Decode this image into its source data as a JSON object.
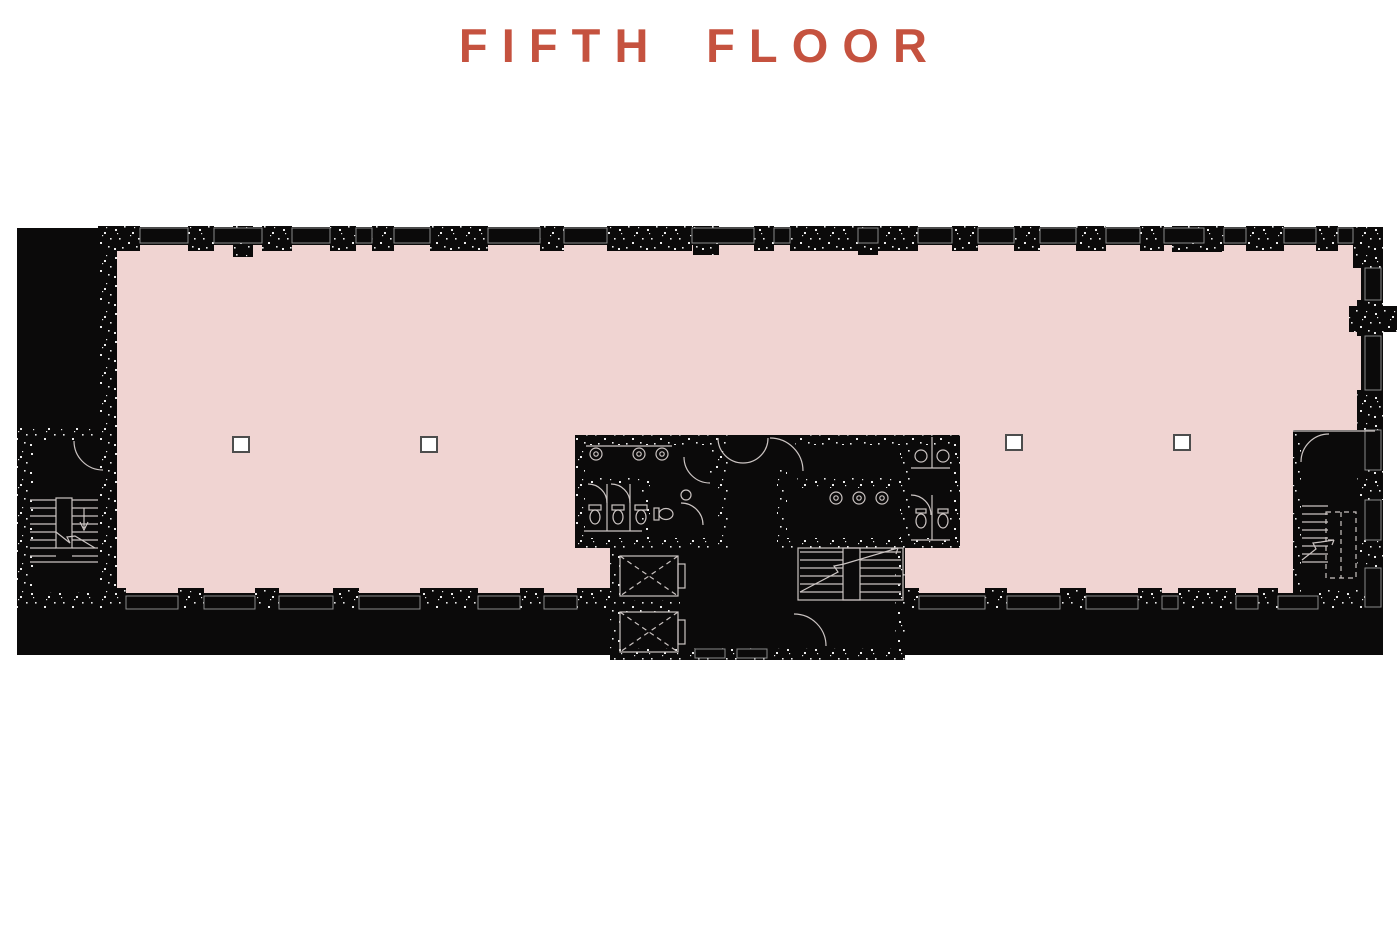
{
  "title": {
    "text": "FIFTH FLOOR"
  },
  "theme": {
    "background": "#FFFFFF",
    "accent": "#C5523F",
    "floor_fill": "#F0D4D2",
    "wall_fill": "#0B0A0A",
    "detail_line": "#CBC4C2",
    "window_line": "#8A8A8A",
    "column_fill": "#FFFFFF",
    "column_stroke": "#4D4D4D"
  },
  "plan": {
    "name": "fifth-floor-plan",
    "areas": {
      "open_floor": "Open floor area",
      "left_stairwell": "West stairwell",
      "right_stairwell": "East stairwell",
      "core_stairwell": "Core stairwell",
      "elevator_bank": "Elevator bank",
      "restroom_left": "Restroom (west core)",
      "restroom_right": "Restroom (east core)"
    }
  }
}
